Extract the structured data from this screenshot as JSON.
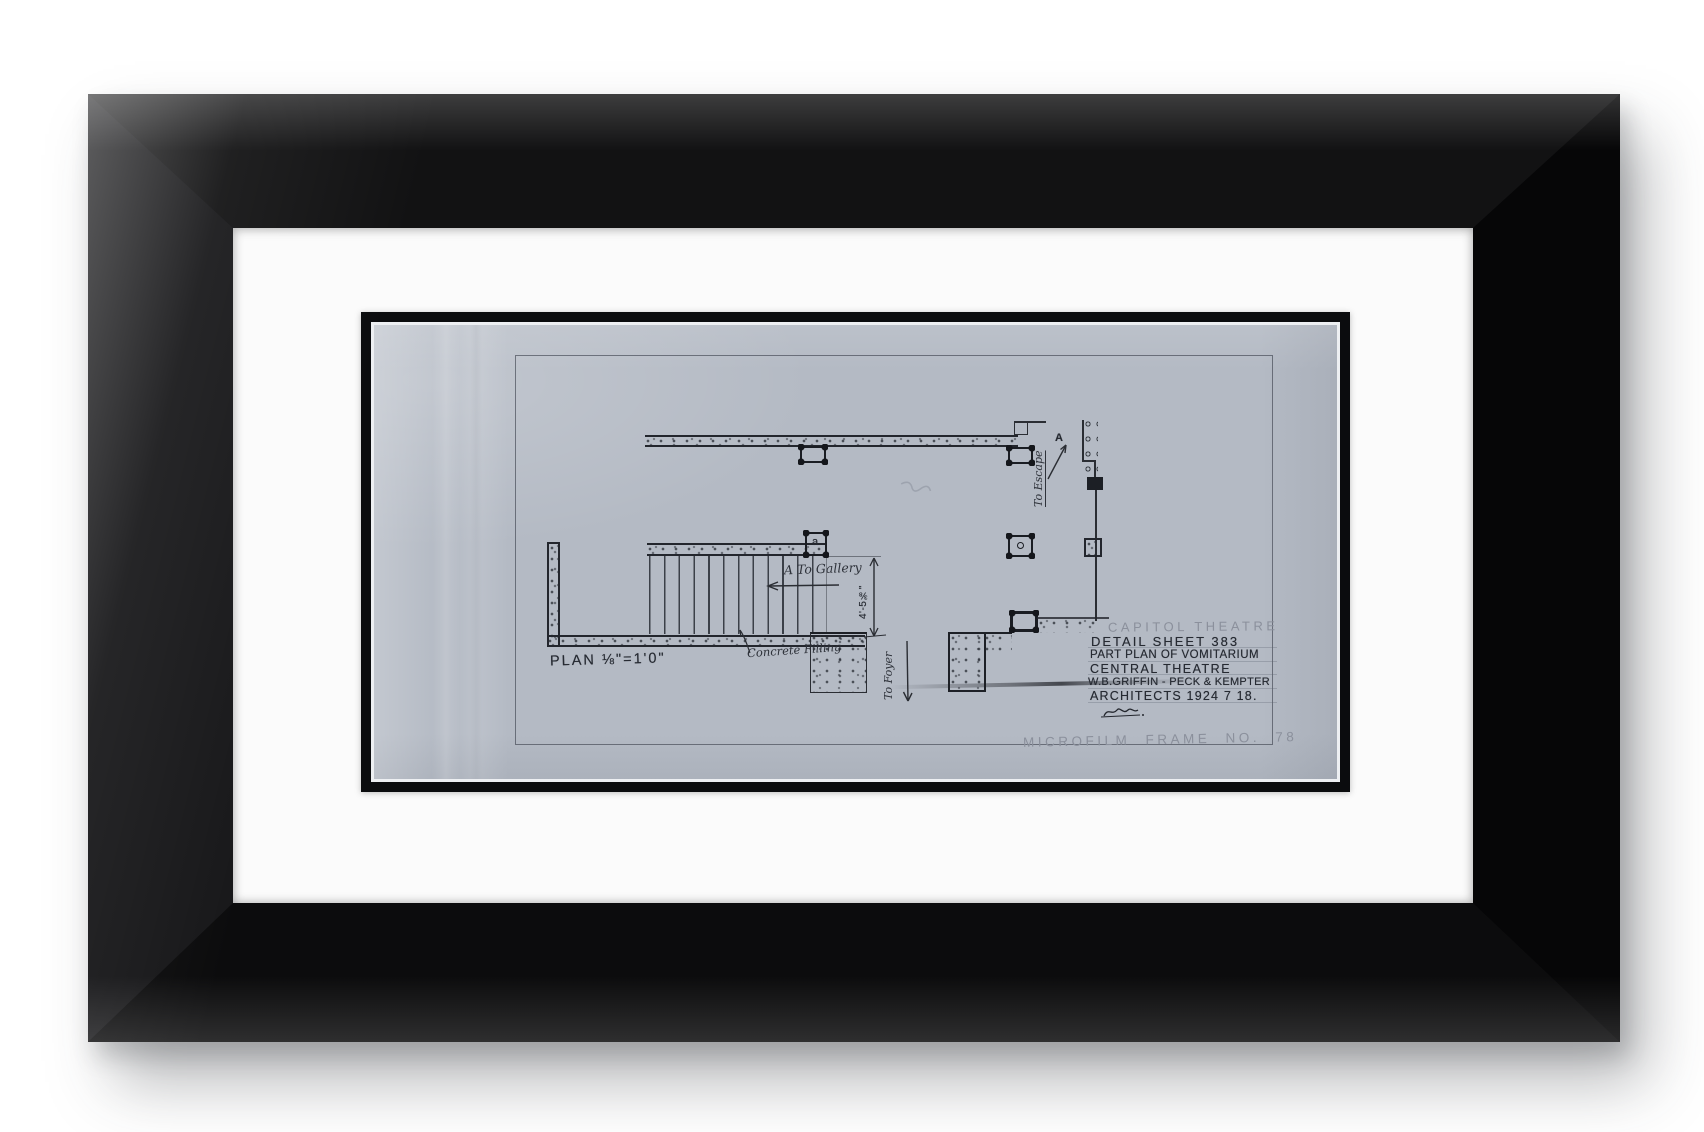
{
  "drawing": {
    "labels": {
      "plan_scale": "PLAN ⅛\"=1'0\"",
      "concrete_filling": "Concrete Filling",
      "to_gallery": "A To Gallery",
      "to_foyer": "To Foyer",
      "to_escape": "To Escape",
      "section_marker": "A",
      "column_mark": "a",
      "dimension": "4'-5⅜\""
    },
    "title_block": {
      "project_pencil": "CAPITOL THEATRE",
      "lines": [
        "DETAIL SHEET 383",
        "PART PLAN OF VOMITARIUM",
        "CENTRAL THEATRE",
        "W.B.GRIFFIN - PECK & KEMPTER",
        "ARCHITECTS 1924 7 18."
      ]
    },
    "annotation": "MICROFILM FRAME NO. 78",
    "colors": {
      "sheet": "#b4bac4",
      "ink": "#23262d",
      "pencil": "#8b909c",
      "frame": "#0b0c0e",
      "mat": "#fbfbfb"
    }
  }
}
